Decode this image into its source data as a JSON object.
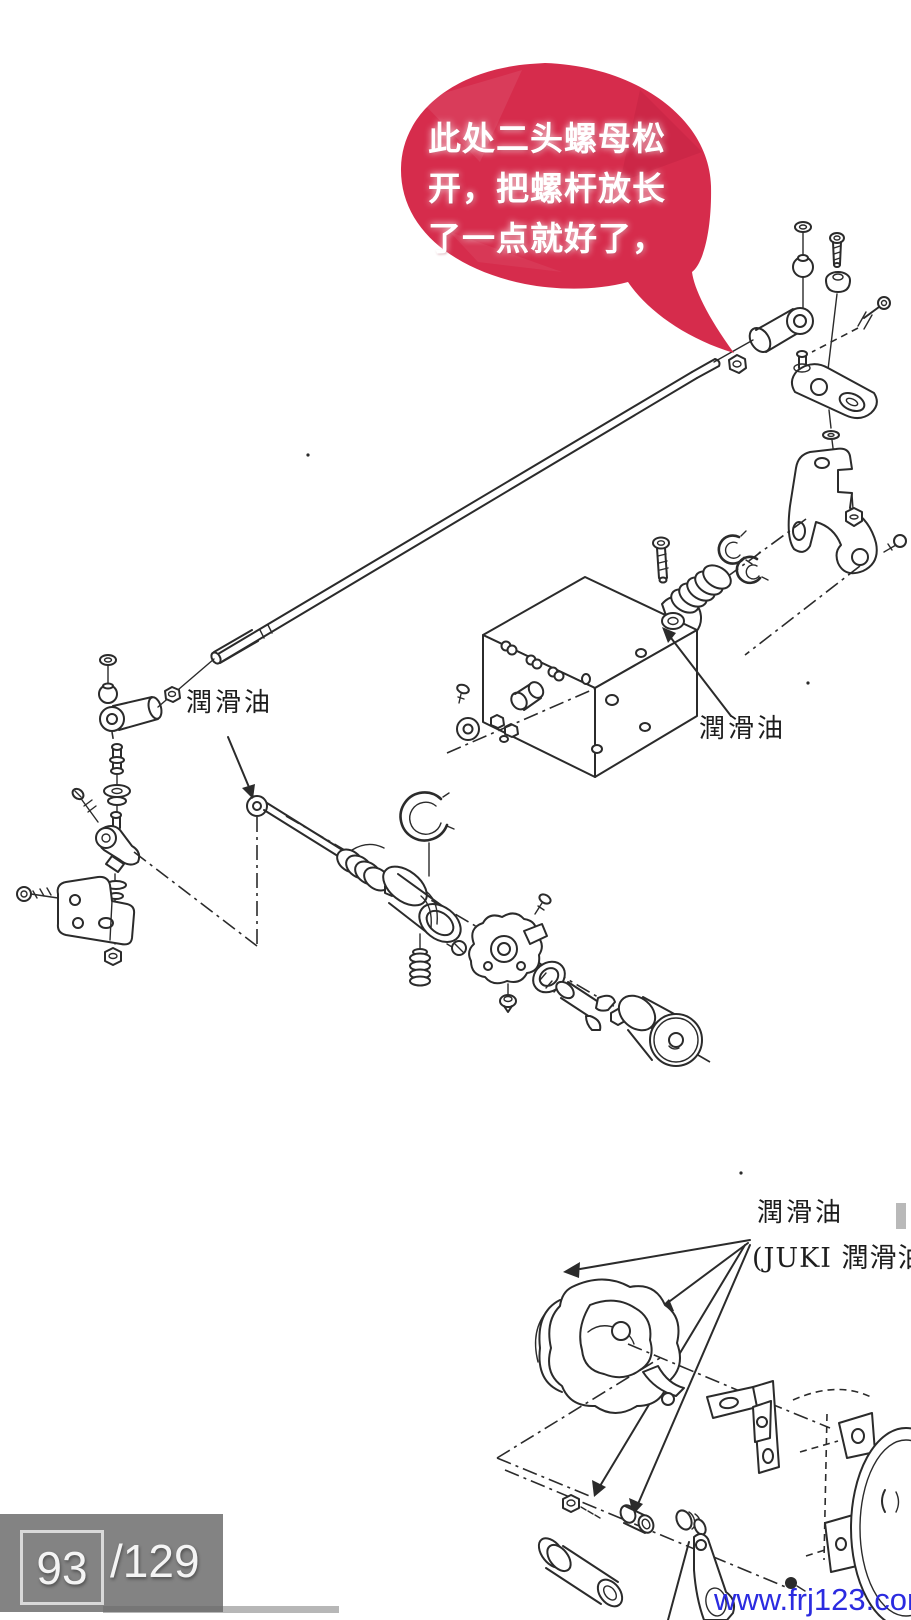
{
  "annotation": {
    "bubble_lines": [
      "此处二头螺母松",
      "开，把螺杆放长",
      "了一点就好了，"
    ]
  },
  "diagram": {
    "labels": {
      "lubricant_left": "潤滑油",
      "lubricant_right": "潤滑油",
      "lubricant_bottom": "潤滑油",
      "juki_note": "(JUKI 潤滑油"
    }
  },
  "viewer": {
    "pager": {
      "current": "93",
      "of": "/129"
    },
    "watermark": "www.frj123.com"
  },
  "colors": {
    "bubble": "#d62c4c",
    "bubble_text": "#ffffff",
    "watermark_blue": "#2b2be0",
    "ink": "#2b2b2b",
    "overlay_gray": "#686868"
  }
}
